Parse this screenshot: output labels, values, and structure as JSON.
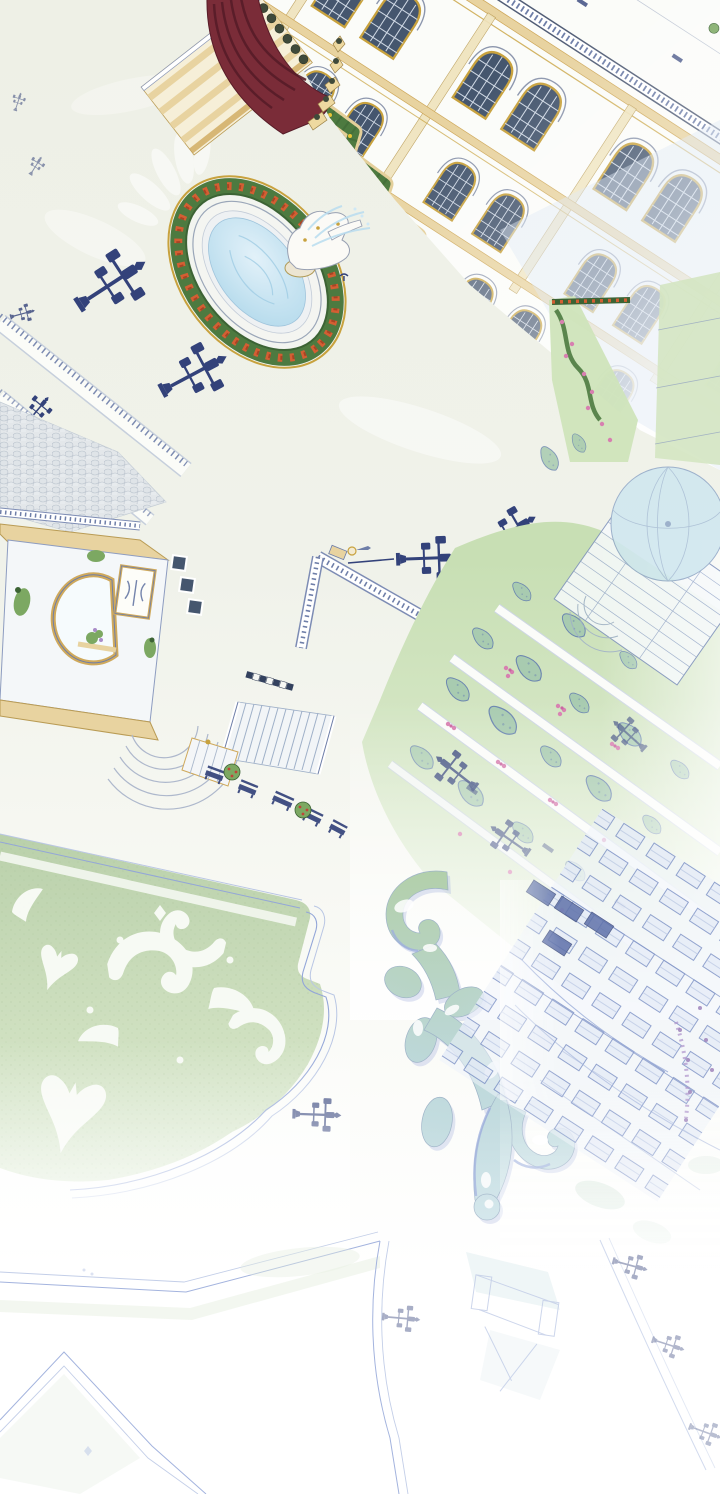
{
  "meta": {
    "type": "illustration-panel",
    "description": "Aerial hand-drawn illustration (webtoon style) of a baroque palace and its formal gardens: ornate facade with arched windows, red-canopied grand staircase, oval fountain ringed by hedges and orange flowers, lamppost-lined promenades, a gated pavilion, terraced lawns with tree rows and pink shrubs, a glass-domed conservatory, a sage-green parterre lawn with white scrollwork, a giant scroll-shaped hedge ornament, all fading to white toward the bottom.",
    "width_px": 720,
    "height_px": 1494
  },
  "scene": {
    "labels": {
      "background": "Ivory plaza ground fading to white",
      "palace": "Palace facade with gilded arched windows",
      "awning_stairs": "Grand staircase with dark-red curved canopy",
      "fountain": "Oval fountain with statue and flower hedge ring",
      "statue": "White marble statue spraying water",
      "bird": "Small blue bird near fountain",
      "lamps": "Wrought-iron multi-lantern streetlamps",
      "promenade": "Cobbled promenade with baluster rows",
      "gate": "Garden gate pavilion with horseshoe arch",
      "terrace": "Balustraded terrace edges and wide stairs",
      "benches": "Dark garden benches with planters",
      "lawn": "Terraced lawns with tree rows and pink shrubs",
      "dome_pavilion": "Glass-domed conservatory pavilion",
      "parterre": "Sage parterre lawn with white scroll ornaments",
      "scroll_hedge": "Giant scroll-shaped hedge ornament",
      "annex": "Faded annex facade with window grid",
      "faint_paths": "Faint garden path outlines at bottom",
      "watermarks": "Soft white petal watermarks"
    }
  },
  "palette": {
    "bg": "#eef0e6",
    "bg2": "#f8f9f4",
    "white": "#ffffff",
    "paper": "#fbfcf9",
    "navy": "#33427a",
    "navyMid": "#6e7ea8",
    "navyLight": "#93a6d8",
    "navyFaint": "#b9c6e4",
    "slate": "#45566e",
    "windowGrid": "#cfd8e4",
    "maroon": "#7a2c38",
    "maroonDark": "#571c28",
    "tan": "#e8d3a0",
    "tanDeep": "#cfa95c",
    "gold": "#c8a23e",
    "hedge": "#4d7a40",
    "hedgeDark": "#3c6334",
    "greenMid": "#7ca862",
    "lawn": "#c6deb2",
    "lawnPale": "#e2eed6",
    "tree": "#a8cbb0",
    "treeEdge": "#6c86b0",
    "pink": "#d77fb0",
    "pinkDeep": "#c963a0",
    "orange": "#d35f33",
    "orangeDeep": "#a84424",
    "yellow": "#e7c437",
    "water": "#d6ebf6",
    "waterDeep": "#aed7ea",
    "sage": "#b9d0aa",
    "sagePale": "#dcead2",
    "scrollShadow": "#aab6e0",
    "purple": "#a98cc8",
    "cobble": "#e3e7ea",
    "cobbleEdge": "#b9c2cc",
    "stone": "#f4f5f1",
    "stoneEdge": "#9aa6b8",
    "bush": "#3f4a3a"
  }
}
